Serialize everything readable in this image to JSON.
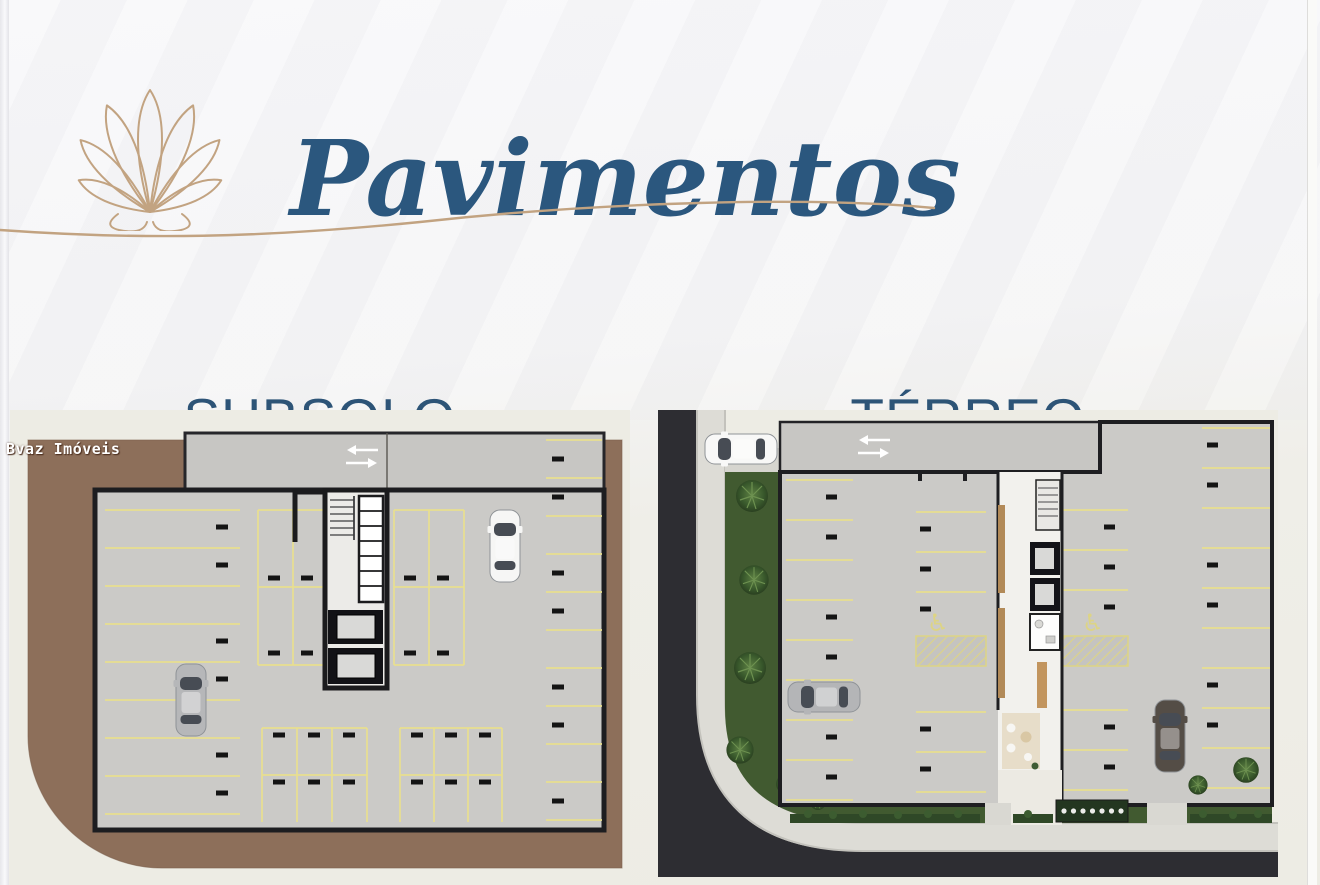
{
  "header": {
    "title": "Pavimentos"
  },
  "sections": [
    {
      "id": "subsolo",
      "label": "SUBSOLO"
    },
    {
      "id": "terreo",
      "label": "TÉRREO"
    }
  ],
  "watermark": {
    "text": "Bvaz Imóveis"
  },
  "glyphs": {
    "accessible": "♿"
  },
  "icons": [
    {
      "name": "shell-logo-icon",
      "meaning": "seashell line-art brand logo"
    },
    {
      "name": "ramp-arrows-icon",
      "meaning": "two-way drive direction arrows"
    },
    {
      "name": "accessible-parking-icon",
      "meaning": "wheelchair accessible parking stall"
    }
  ],
  "colors": {
    "title_blue": "#2b577e",
    "heading_blue": "#2d5477",
    "gold": "#c2a381",
    "earth_brown": "#8d6f5a",
    "floor_gray": "#cbcac7",
    "ramp_gray": "#c7c6c3",
    "stall_yellow": "#e8df90",
    "asphalt_dark": "#2d2d32",
    "sidewalk_gray": "#dddcd6",
    "lawn_green": "#415a30",
    "lobby_white": "#f2f1ed",
    "wood_tan": "#b28a58",
    "background_cream": "#edece4"
  }
}
